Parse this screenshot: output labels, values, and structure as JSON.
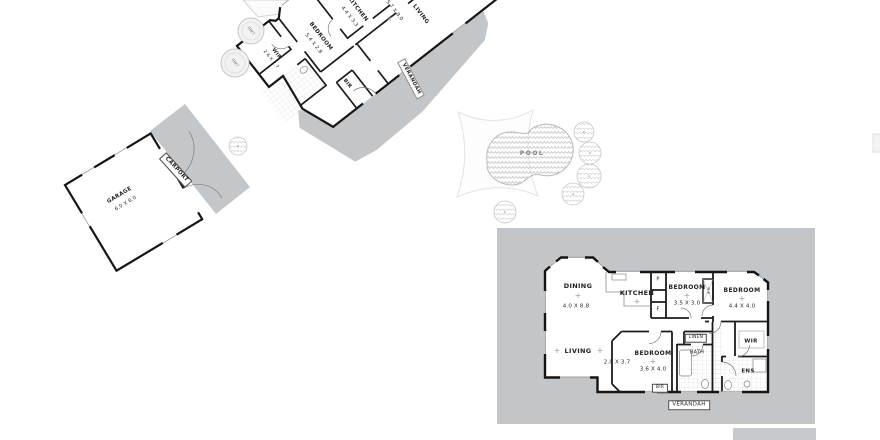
{
  "colors": {
    "verandah_gray": "#c3c6c9",
    "carport_gray": "#c4c7ca",
    "wall_black": "#161616",
    "pool_outline": "#b7babc"
  },
  "sym": {
    "plus": "+"
  },
  "site": {
    "cottage": {
      "kitchen_label": "KITCHEN",
      "kitchen_dims": "4.4 X 3.3",
      "living_label": "LIVING",
      "living_dims": "5.7 X 9.0",
      "bedroom_label": "BEDROOM",
      "bedroom_dims": "5.4 X 2.8",
      "wir_label": "WIR",
      "wir_dims": "2.6 X 2.7",
      "bir_label": "BIR",
      "verandah_label": "VERANDAH",
      "tank1_label": "RWT",
      "tank2_label": "RWT"
    },
    "garage": {
      "label": "GARAGE",
      "dims": "6.0 X 6.0",
      "carport_label": "CARPORT"
    },
    "pool": {
      "label": "POOL"
    },
    "house": {
      "dining_label": "DINING",
      "dining_dims": "4.0 X 8.8",
      "kitchen_label": "KITCHEN",
      "pantry_label": "P",
      "fridge_label": "F",
      "bed1_label": "BEDROOM",
      "bed1_dims": "3.5 X 3.0",
      "robe_label": "BR",
      "bed2_label": "BEDROOM",
      "bed2_dims": "4.4 X 4.0",
      "living_label": "LIVING",
      "living_dims": "2.0 X 3.7",
      "bed3_label": "BEDROOM",
      "bed3_dims": "3.6 X 4.0",
      "linen_label": "LINEN",
      "bath_label": "BATH",
      "wir_label": "WIR",
      "ens_label": "ENS",
      "bir_label": "BIR",
      "verandah_label": "VERANDAH"
    }
  }
}
